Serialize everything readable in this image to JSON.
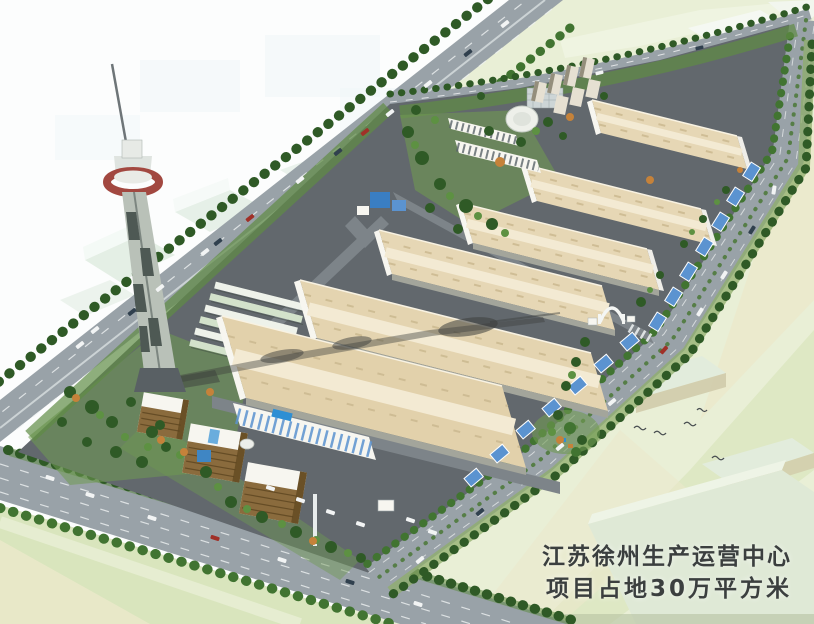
{
  "meta": {
    "kind": "aerial architectural rendering",
    "subject": "industrial logistics park master plan with observation tower"
  },
  "caption": {
    "line1": "江苏徐州生产运营中心",
    "line2": "项目占地30万平方米"
  },
  "palette": {
    "bg": "#fcfdfd",
    "ghost": "#eff5f7",
    "ghostGreen": "#d9e8da",
    "field": "#d9e5bd",
    "fieldLight": "#e9efd6",
    "fieldCream": "#ebe8cb",
    "road": "#99a2a8",
    "roadDark": "#858e94",
    "siteGray": "#62686d",
    "innerRoad": "#7d8489",
    "roofBeige": "#e6d7b5",
    "roofRidge": "#f3ead3",
    "roofDash": "#cbb990",
    "wall": "#f7f6f0",
    "wallShade": "#a3a59b",
    "stripeBlue": "#5b93d0",
    "canopy": "#eef2ea",
    "canopyGreen": "#d3e2cb",
    "treeDark": "#2f5a26",
    "tree": "#417431",
    "treeLight": "#5d9142",
    "grass": "#8fae6b",
    "lawn": "#6f9a52",
    "orangeTree": "#c5823a",
    "officeGold": "#8a6b3d",
    "officeDark": "#6a5026",
    "towerGray": "#b9c1b8",
    "towerRed": "#a24840",
    "shadow": "#3c3e3c",
    "poolBlue": "#2e8fd4",
    "carWhite": "#f2f4f4",
    "carRed": "#a03028",
    "carDark": "#30404e",
    "text": "#3b3f3f"
  }
}
